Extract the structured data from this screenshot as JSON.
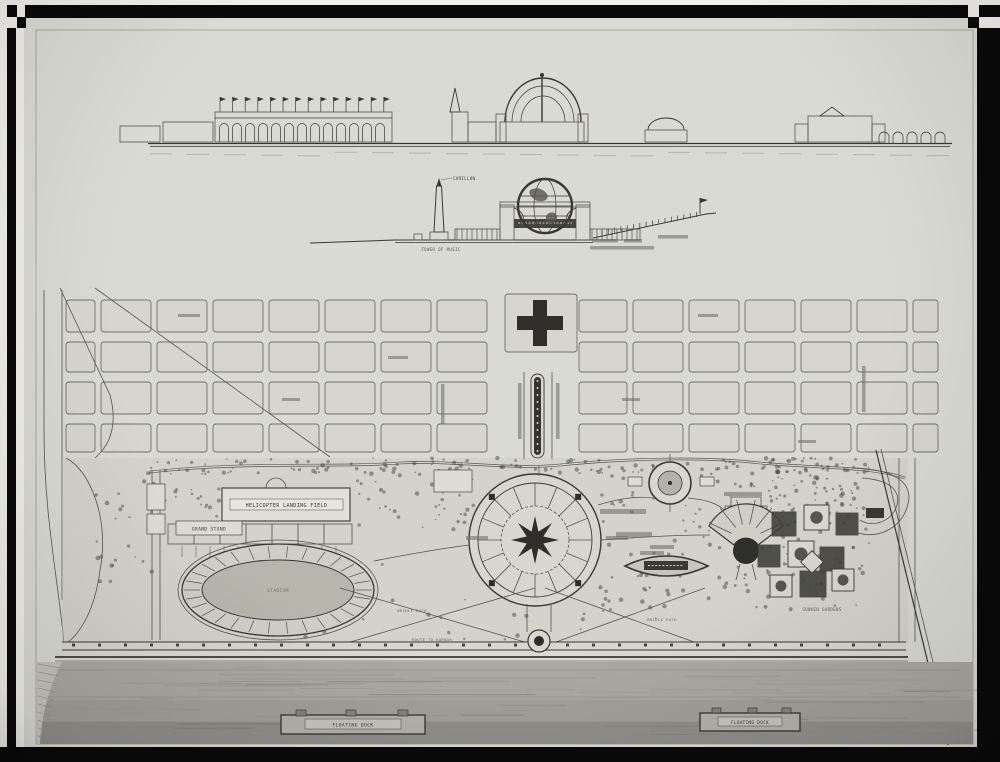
{
  "photo_meta": {
    "description_of_visible_content": "black-and-white photograph of an architectural rendering: waterfront exposition/park master plan with two elevation drawings above a large site plan, framed by black film-mask bars with checkered registration corners"
  },
  "colors": {
    "paper": "#d9d8d3",
    "ink": "#3a3833",
    "water": "#a9a8a2",
    "frame": "#0a0a0a",
    "infield": "#b7b5ac"
  },
  "labels": {
    "carillon": "CARILLON",
    "tower_caption": "TOWER OF MUSIC",
    "helicopter_field": "HELICOPTER LANDING FIELD",
    "grand_stand": "GRAND STAND",
    "stadium": "STADIUM",
    "bridle_path_west": "BRIDLE PATH",
    "bridle_path_east": "BRIDLE PATH",
    "route_to_harbor": "ROUTE TO HARBOR",
    "sunken_gardens": "SUNKEN GARDENS",
    "floating_dock_left": "FLOATING DOCK",
    "floating_dock_right": "FLOATING DOCK"
  }
}
